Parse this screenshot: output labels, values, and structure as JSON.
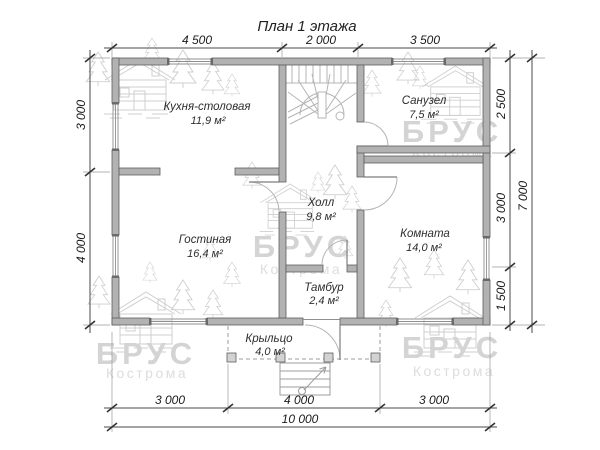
{
  "title": "План 1 этажа",
  "rooms": {
    "kitchen": {
      "name": "Кухня-столовая",
      "area": "11,9 м²"
    },
    "bathroom": {
      "name": "Санузел",
      "area": "7,5 м²"
    },
    "hall": {
      "name": "Холл",
      "area": "9,8 м²"
    },
    "living": {
      "name": "Гостиная",
      "area": "16,4 м²"
    },
    "room": {
      "name": "Комната",
      "area": "14,0 м²"
    },
    "vestibule": {
      "name": "Тамбур",
      "area": "2,4 м²"
    },
    "porch": {
      "name": "Крыльцо",
      "area": "4,0 м²"
    }
  },
  "dims": {
    "top": [
      "4 500",
      "2 000",
      "3 500"
    ],
    "left": [
      "3 000",
      "4 000"
    ],
    "right": [
      "2 500",
      "3 000",
      "1 500"
    ],
    "right_total": "7 000",
    "bottom": [
      "3 000",
      "4 000",
      "3 000"
    ],
    "bottom_total": "10 000"
  },
  "watermark": {
    "brand": "БРУС",
    "city": "Кострома"
  },
  "icons": {
    "cabin": "log-cabin-watermark",
    "tree": "pine-tree-watermark"
  },
  "colors": {
    "wall_fill": "#b2b2b2",
    "wall_stroke": "#5e5e5e",
    "dim_text": "#1a1a1a",
    "room_text": "#2e2e2e",
    "watermark": "#d4d4d4",
    "background": "#ffffff"
  }
}
